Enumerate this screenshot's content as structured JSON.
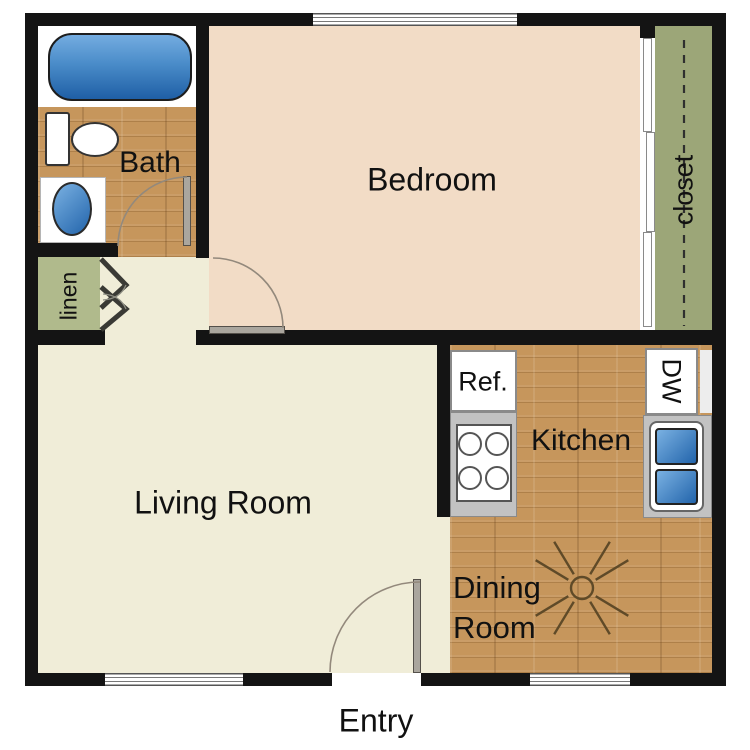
{
  "rooms": {
    "bath": {
      "label": "Bath"
    },
    "bedroom": {
      "label": "Bedroom"
    },
    "closet": {
      "label": "closet"
    },
    "linen": {
      "label": "linen"
    },
    "living_room": {
      "label": "Living Room"
    },
    "kitchen": {
      "label": "Kitchen"
    },
    "dining_room": {
      "line1": "Dining",
      "line2": "Room"
    },
    "entry": {
      "label": "Entry"
    }
  },
  "appliances": {
    "refrigerator": {
      "label": "Ref."
    },
    "dishwasher": {
      "label": "DW"
    }
  },
  "fixtures": [
    "bathtub",
    "toilet",
    "bath-sink",
    "stove-cooktop",
    "kitchen-double-sink",
    "ceiling-fan",
    "sliding-closet-doors",
    "bifold-linen-doors",
    "bath-door",
    "bedroom-door",
    "entry-door",
    "windows"
  ],
  "colors": {
    "wall": "#141414",
    "bedroom_floor": "#f2dcc6",
    "living_floor": "#f0edd8",
    "wood_floor": "#c6965c",
    "closet_green": "#9ca678",
    "linen_green": "#b0ba8c",
    "fixture_blue": "#2f6fb5",
    "counter_gray": "#c2c2c2",
    "label_color": "#111111"
  }
}
